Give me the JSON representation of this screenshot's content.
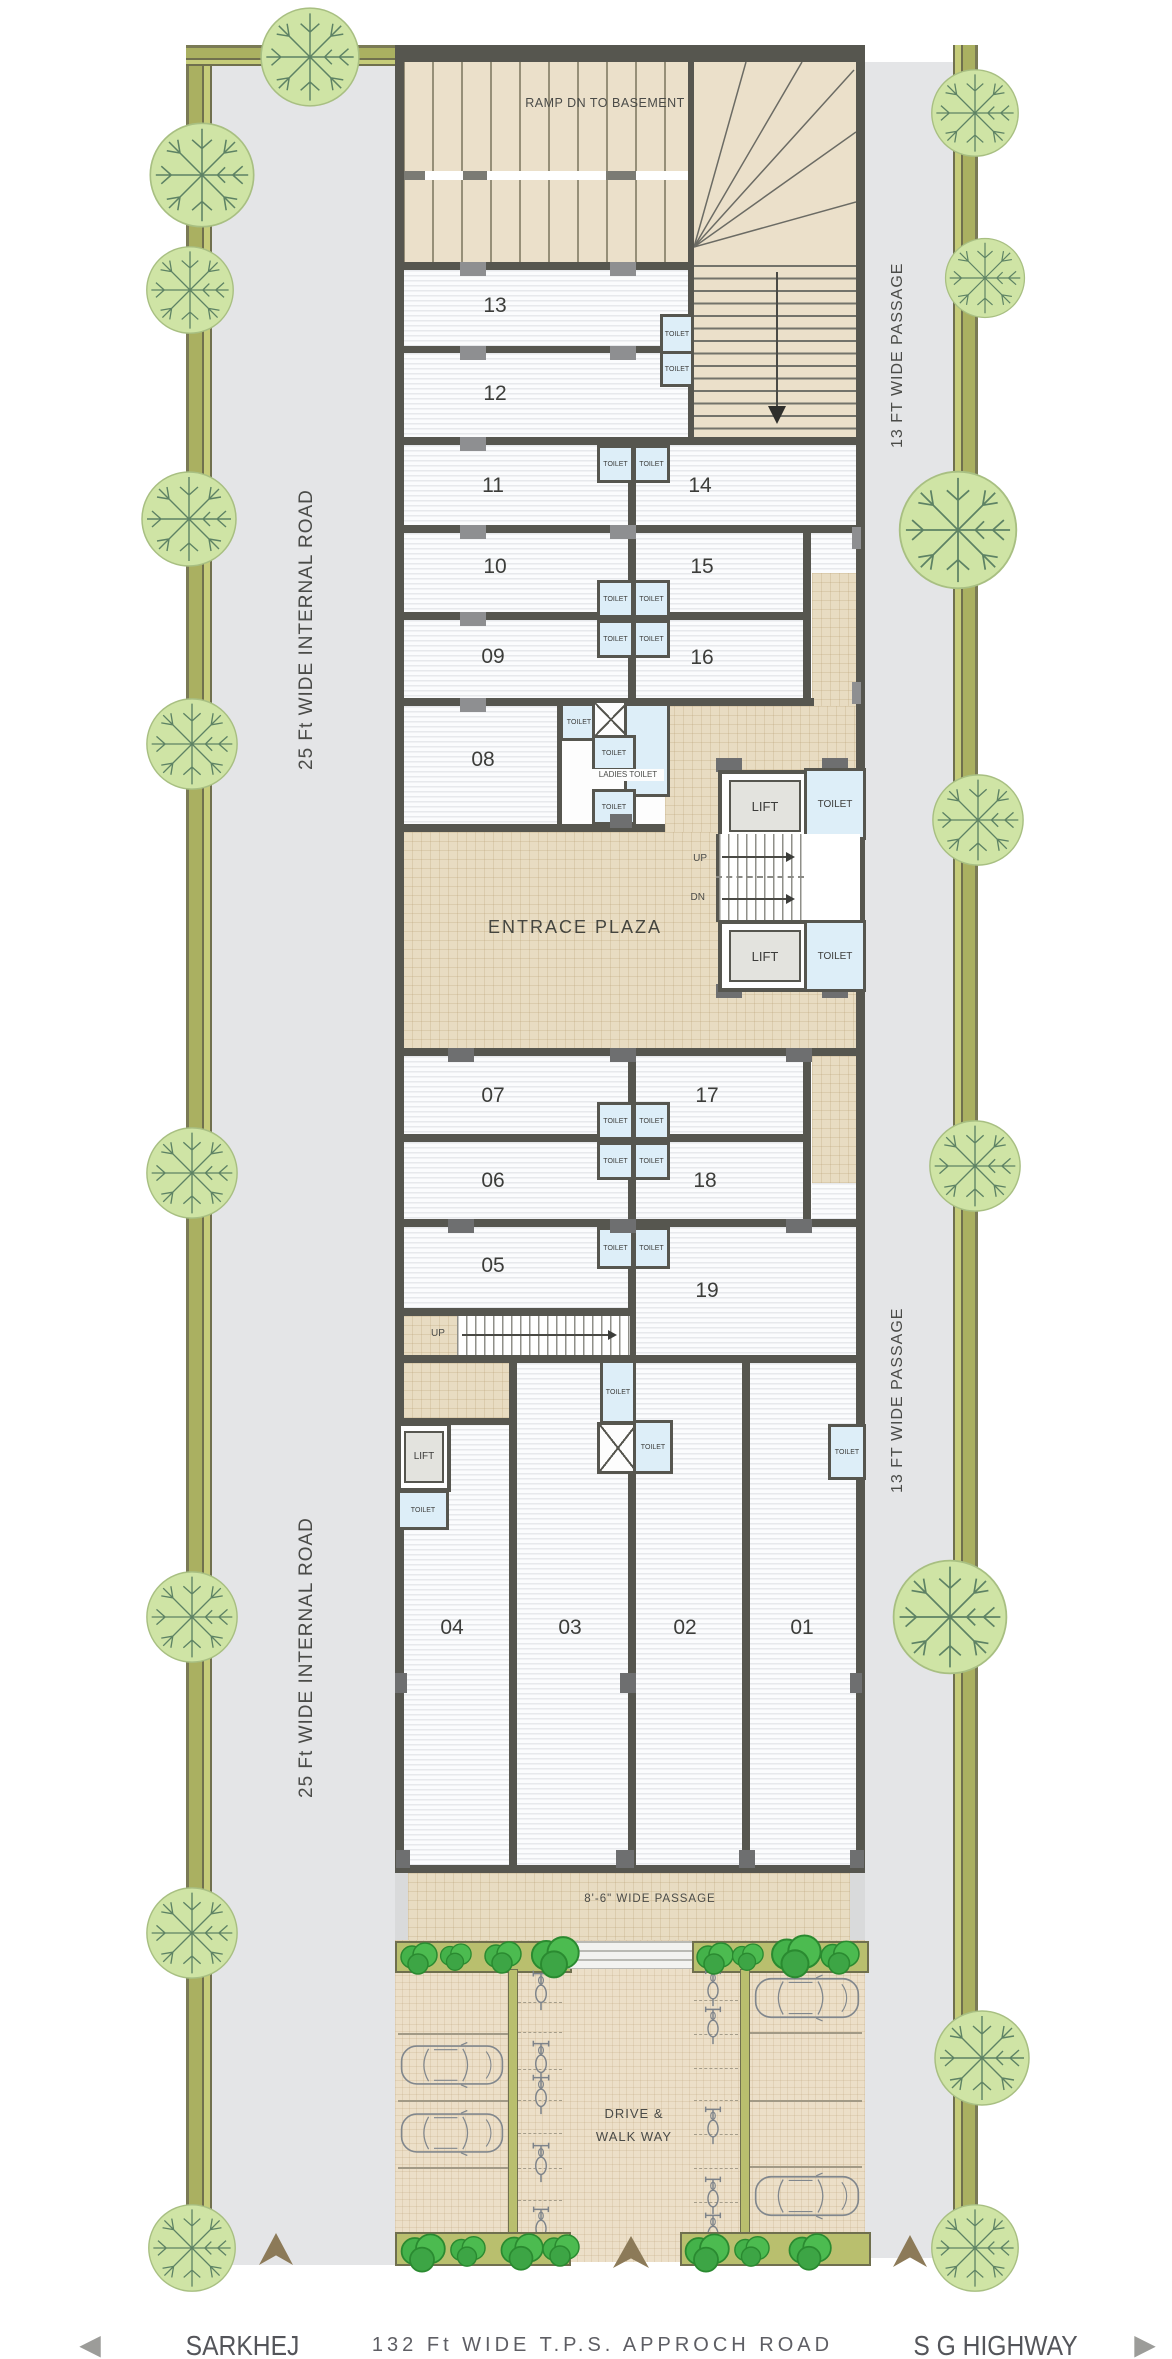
{
  "plan": {
    "labels": {
      "ramp": "RAMP DN TO BASEMENT",
      "entrance_plaza": "ENTRACE PLAZA",
      "up": "UP",
      "dn": "DN",
      "lift": "LIFT",
      "toilet": "TOILET",
      "ladies_toilet": "LADIES TOILET"
    },
    "units": {
      "u01": "01",
      "u02": "02",
      "u03": "03",
      "u04": "04",
      "u05": "05",
      "u06": "06",
      "u07": "07",
      "u08": "08",
      "u09": "09",
      "u10": "10",
      "u11": "11",
      "u12": "12",
      "u13": "13",
      "u14": "14",
      "u15": "15",
      "u16": "16",
      "u17": "17",
      "u18": "18",
      "u19": "19"
    },
    "roads": {
      "internal_road": "25 Ft  WIDE INTERNAL ROAD",
      "side_passage": "13 FT  WIDE PASSAGE",
      "rear_passage": "8'-6\" WIDE PASSAGE",
      "drive_line1": "DRIVE  &",
      "drive_line2": "WALK WAY",
      "left_destination": "SARKHEJ",
      "main_road": "132 Ft WIDE  T.P.S. APPROCH ROAD",
      "right_destination": "S G HIGHWAY",
      "left_arrow": "◀",
      "right_arrow": "▶"
    },
    "colors": {
      "wall": "#56564f",
      "plaza": "#e8dcc2",
      "ramp": "#ebe0ca",
      "toilet_room": "#ddeef8",
      "road": "#e4e5e7",
      "greenbelt": "#aab061",
      "tree": "#cfe4a5",
      "bush": "#3fae46"
    }
  }
}
